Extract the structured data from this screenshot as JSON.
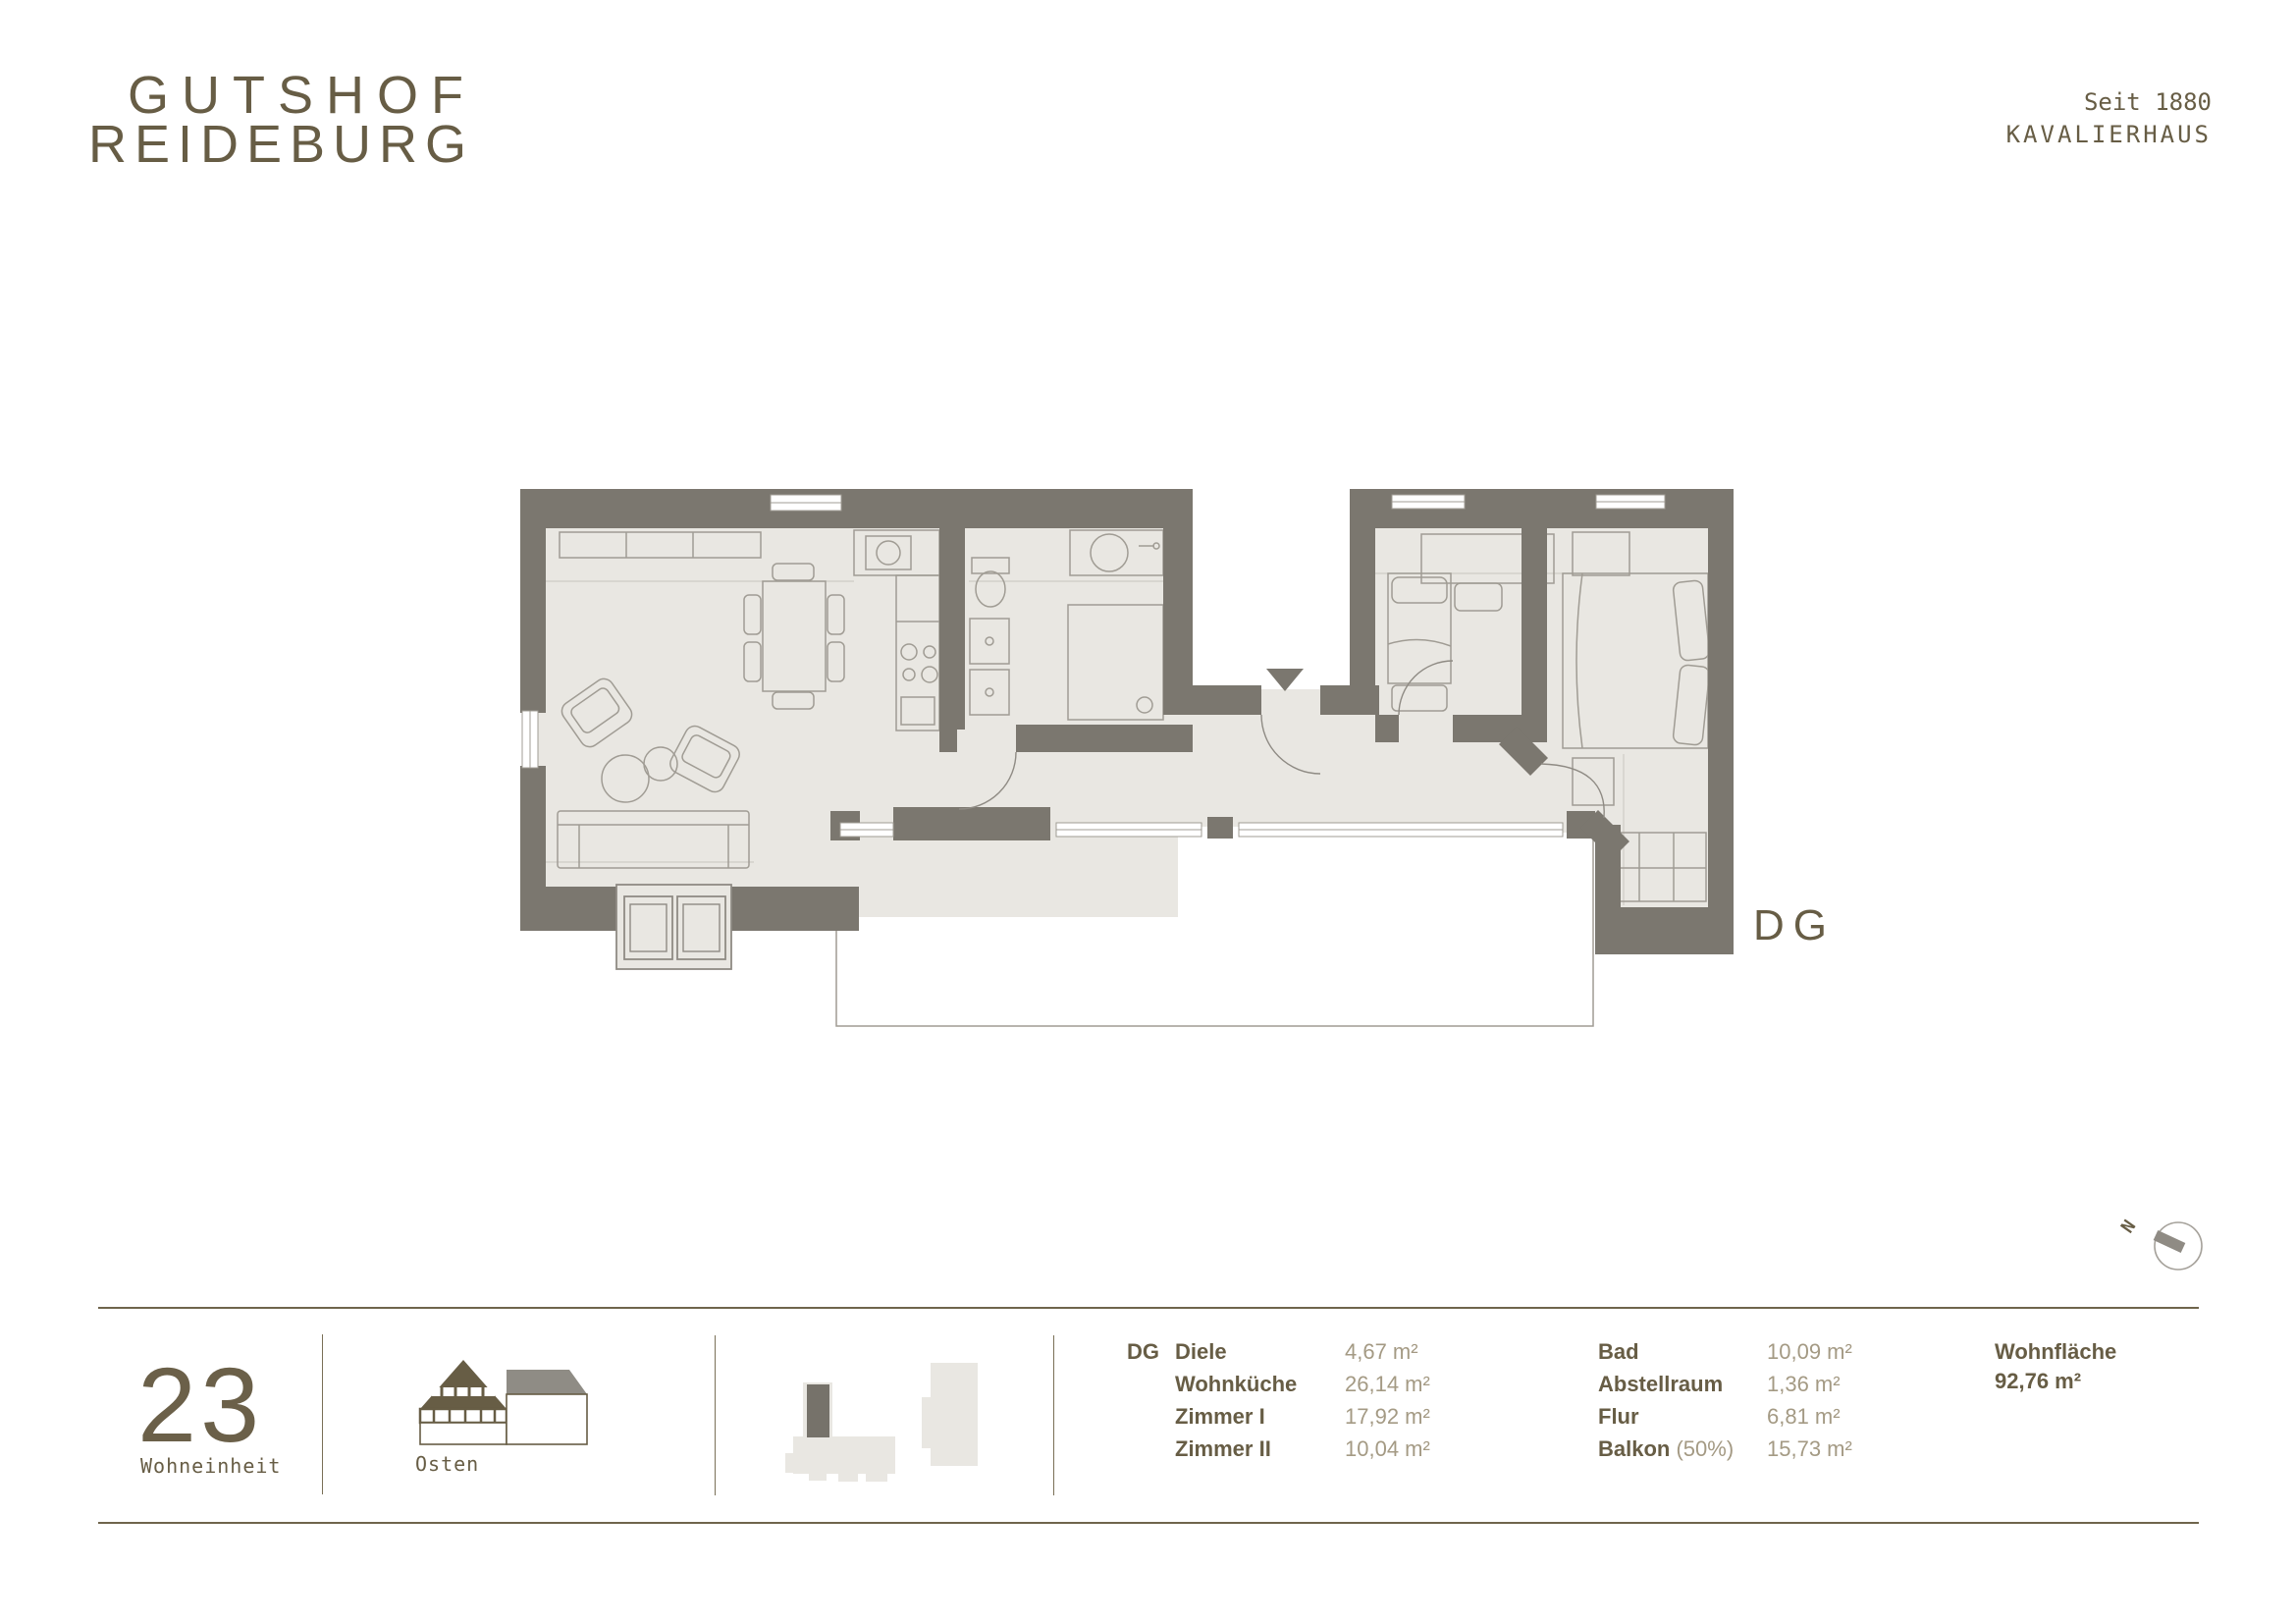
{
  "brand": {
    "logo_line1": "GUTSHOF",
    "logo_line2": "REIDEBURG",
    "tagline_line1": "Seit 1880",
    "tagline_line2": "KAVALIERHAUS"
  },
  "plan": {
    "floor_label": "DG",
    "compass_north": "N"
  },
  "unit": {
    "number": "23",
    "number_label": "Wohneinheit",
    "orientation": "Osten"
  },
  "rooms": {
    "floor_label": "DG",
    "col1": [
      {
        "name": "Diele",
        "area": "4,67 m²"
      },
      {
        "name": "Wohnküche",
        "area": "26,14 m²"
      },
      {
        "name": "Zimmer I",
        "area": "17,92 m²"
      },
      {
        "name": "Zimmer II",
        "area": "10,04 m²"
      }
    ],
    "col2": [
      {
        "name": "Bad",
        "qualifier": "",
        "area": "10,09 m²"
      },
      {
        "name": "Abstellraum",
        "qualifier": "",
        "area": "1,36 m²"
      },
      {
        "name": "Flur",
        "qualifier": "",
        "area": "6,81 m²"
      },
      {
        "name": "Balkon",
        "qualifier": "(50%)",
        "area": "15,73 m²"
      }
    ],
    "total_label": "Wohnfläche",
    "total_area": "92,76 m²"
  },
  "colors": {
    "brand_brown": "#675d45",
    "value_tan": "#a49a84",
    "wall_gray": "#7b776f",
    "floor_light": "#e9e7e2",
    "furniture_line": "#a09c94",
    "roof_gray": "#8f8c85"
  }
}
